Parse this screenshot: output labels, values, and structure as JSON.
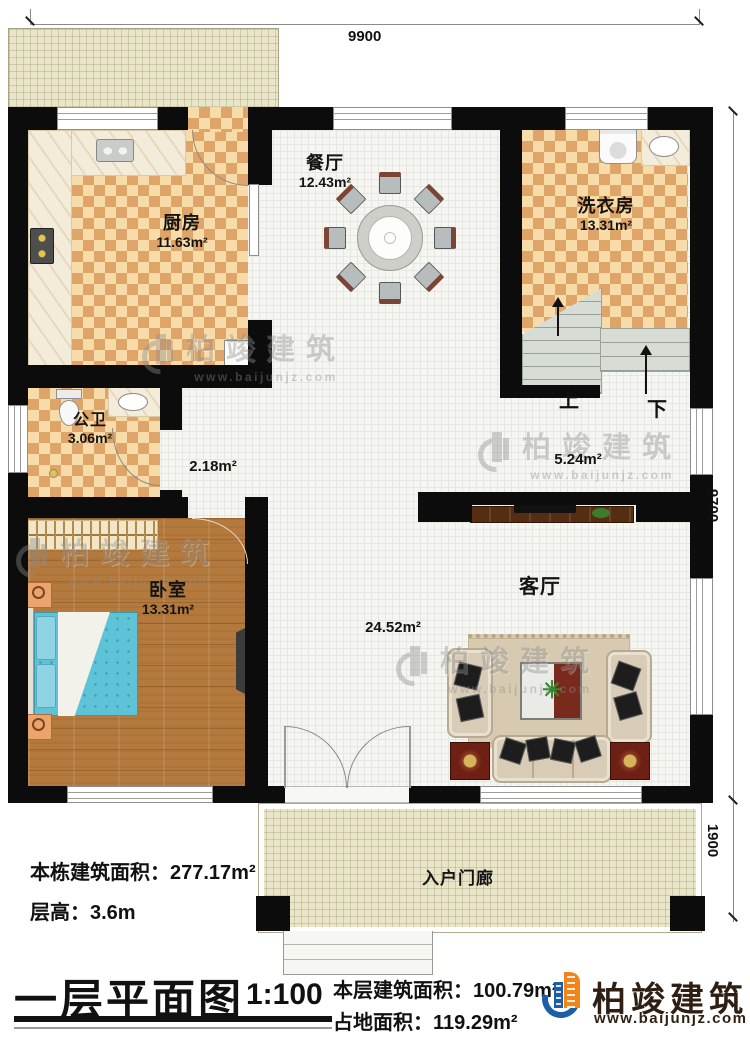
{
  "dimensions": {
    "width_top": "9900",
    "height_right": "9700",
    "porch_depth": "1900"
  },
  "rooms": [
    {
      "name": "厨房",
      "area": "11.63m²"
    },
    {
      "name": "餐厅",
      "area": "12.43m²"
    },
    {
      "name": "洗衣房",
      "area": "13.31m²"
    },
    {
      "name": "公卫",
      "area": "3.06m²"
    },
    {
      "name": "卧室",
      "area": "13.31m²"
    },
    {
      "name": "客厅",
      "area": "24.52m²"
    },
    {
      "name": "入户门廊"
    }
  ],
  "open_areas": {
    "hallway": "2.18m²",
    "stair_landing": "5.24m²"
  },
  "stairs": {
    "up_label": "上",
    "down_label": "下"
  },
  "footer": {
    "total_area_label": "本栋建筑面积：",
    "total_area_value": "277.17m²",
    "floor_height_label": "层高：",
    "floor_height_value": "3.6m",
    "plan_title": "一层平面图",
    "scale": "1:100",
    "floor_area_label": "本层建筑面积：",
    "floor_area_value": "100.79m²",
    "footprint_label": "占地面积：",
    "footprint_value": "119.29m²"
  },
  "brand": {
    "name": "柏竣建筑",
    "website": "www.baijunjz.com"
  },
  "watermark": {
    "name": "柏竣建筑",
    "website": "www.baijunjz.com"
  },
  "colors": {
    "wall": "#0c0c0c",
    "checker": "#dfa468",
    "wood": "#b47a3d",
    "accent_blue": "#1c5fa8",
    "accent_orange": "#f08619"
  }
}
